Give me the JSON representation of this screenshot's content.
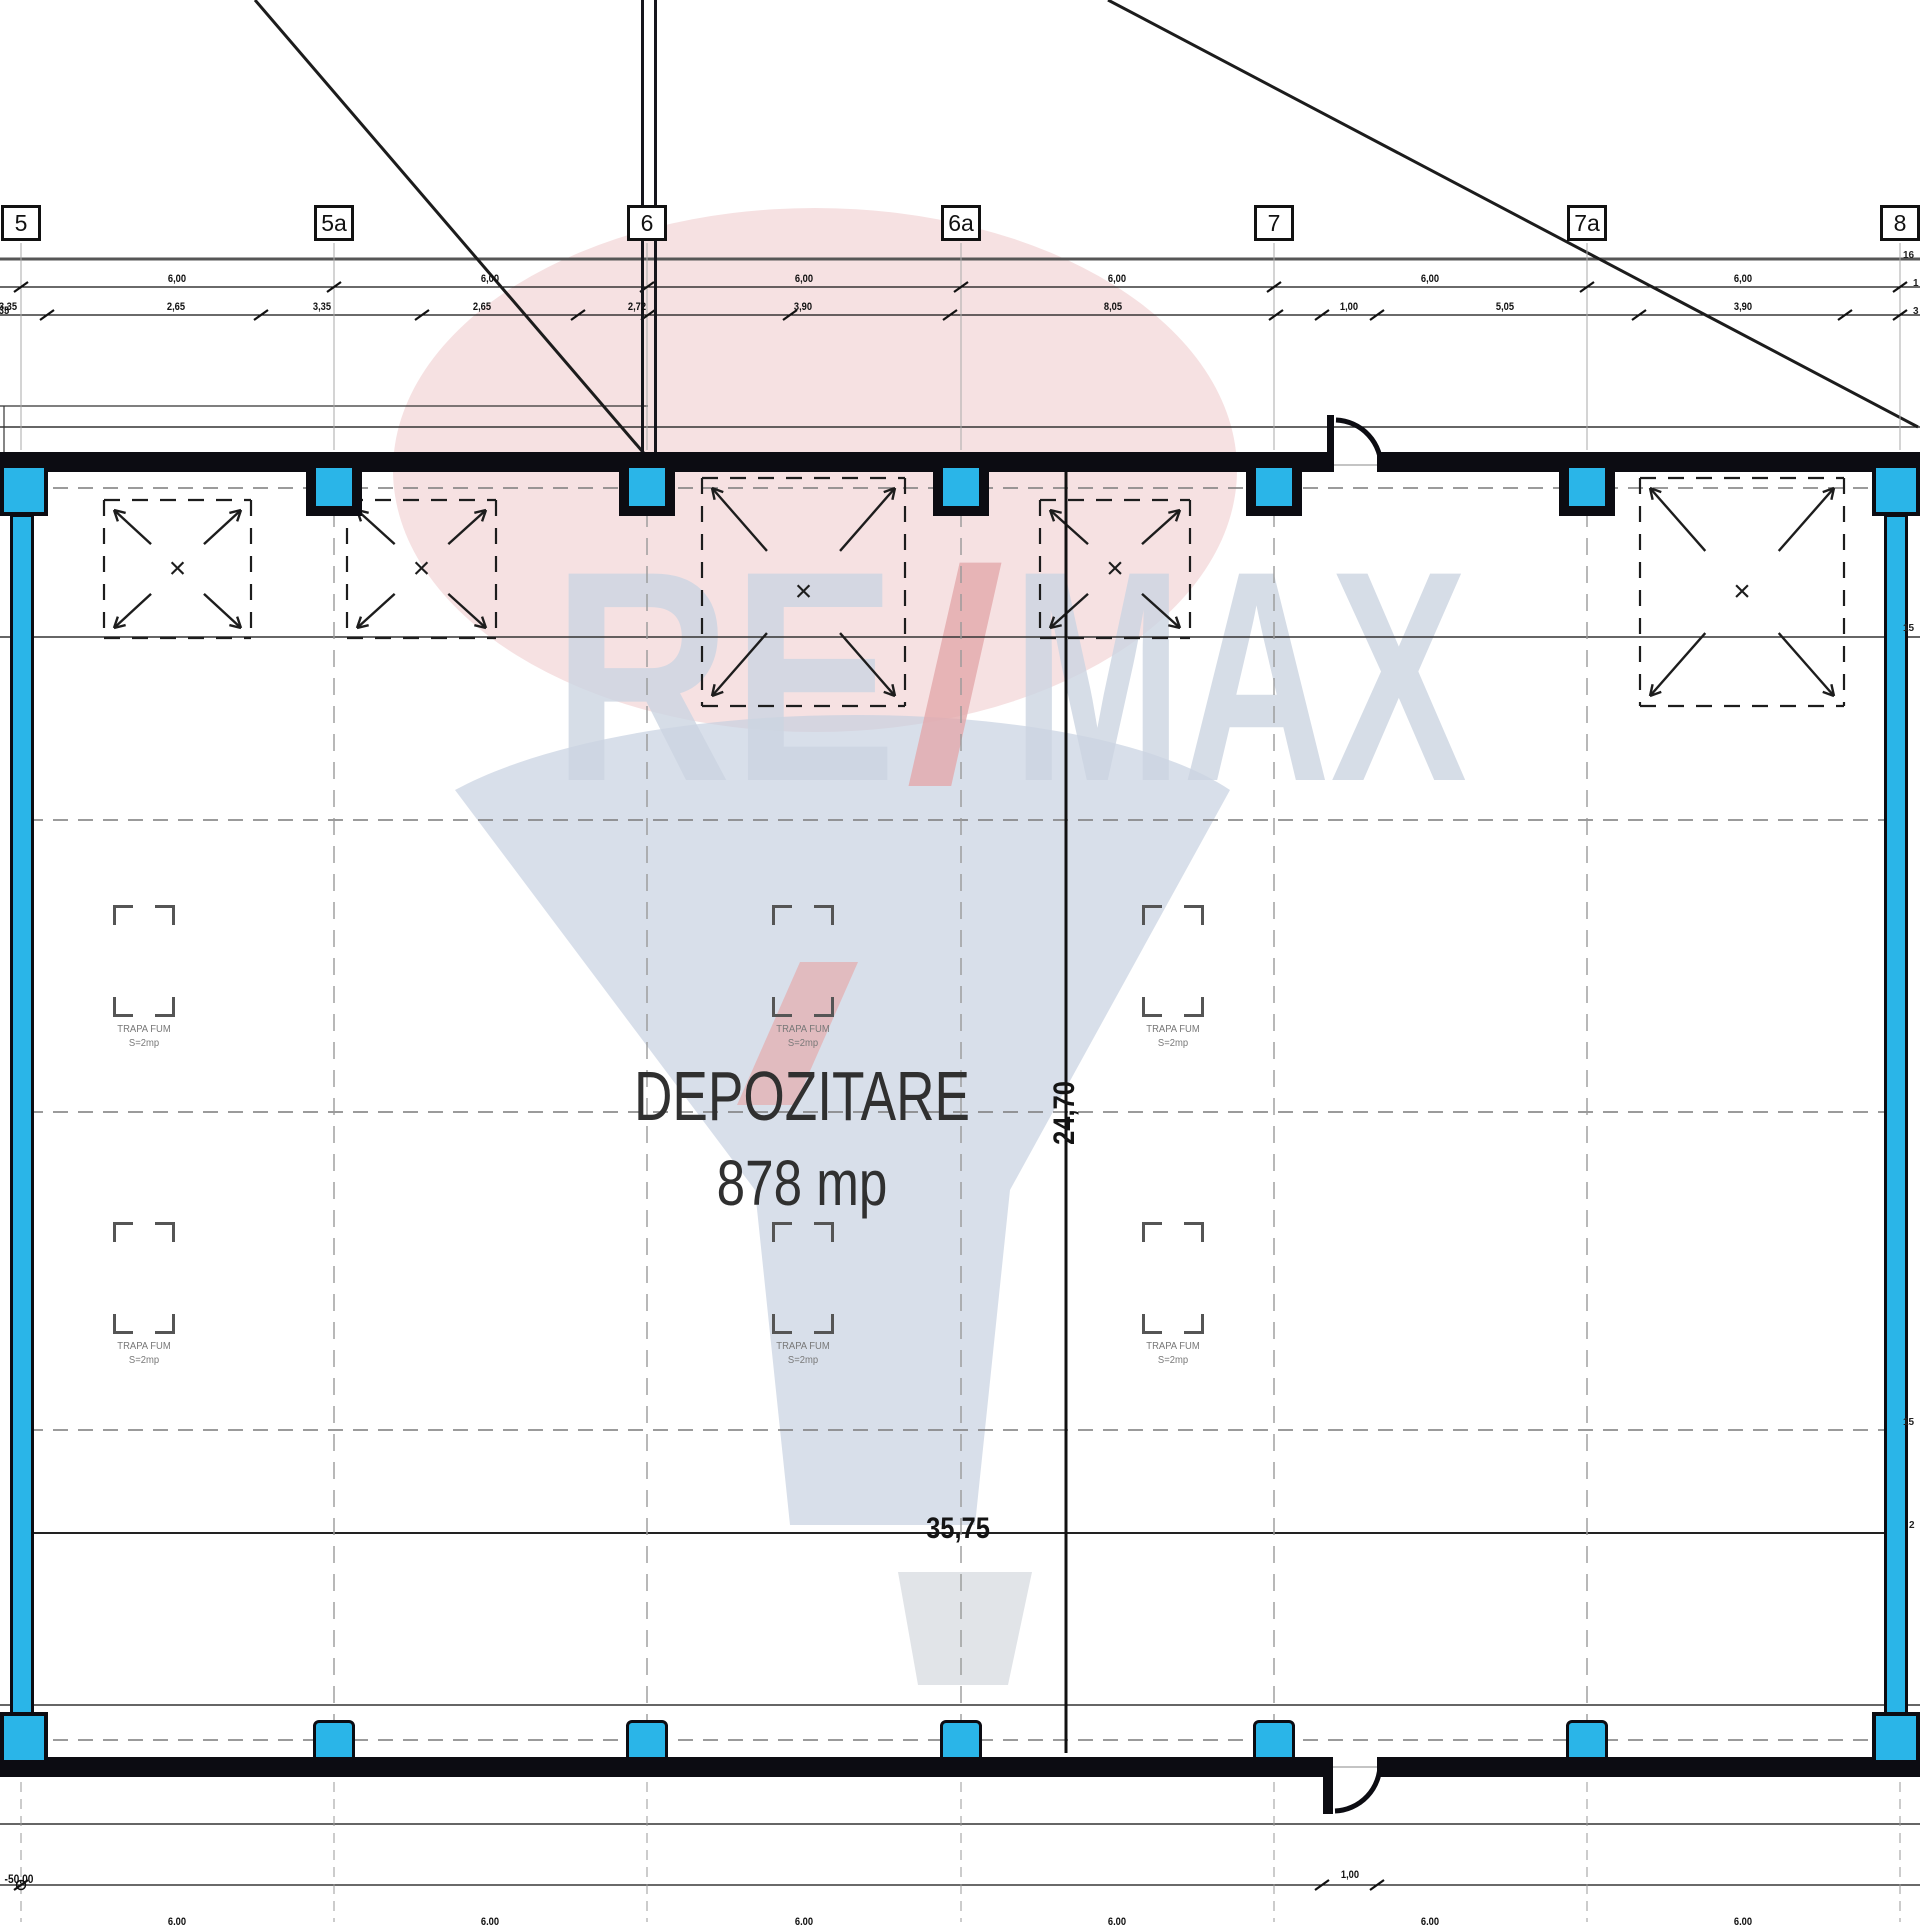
{
  "drawing": {
    "room_label": "DEPOZITARE",
    "room_area": "878 mp",
    "width_dim": "35,75",
    "depth_dim": "24,70",
    "level_dim": "-50,00",
    "door_dim_bottom": "1,00",
    "edge_dim_left": "-3,35"
  },
  "colors": {
    "column_cyan": "#2ab5e8",
    "wall_black": "#0c0c12",
    "balloon_pink": "#eec8ca",
    "balloon_blue": "#c3cedf",
    "balloon_red": "#e6abad",
    "basket_gray": "#dcdfe4"
  },
  "grid_markers": [
    {
      "label": "5",
      "x": 21
    },
    {
      "label": "5a",
      "x": 334
    },
    {
      "label": "6",
      "x": 647
    },
    {
      "label": "6a",
      "x": 961
    },
    {
      "label": "7",
      "x": 1274
    },
    {
      "label": "7a",
      "x": 1587
    },
    {
      "label": "8",
      "x": 1900
    }
  ],
  "dim_row_top": {
    "label": "6,00",
    "positions": [
      177,
      490,
      804,
      1117,
      1430,
      1743
    ],
    "tick_xs": [
      21,
      334,
      647,
      961,
      1274,
      1587,
      1900
    ]
  },
  "dim_row_sub": {
    "labels": [
      {
        "t": "3,35",
        "x": 8
      },
      {
        "t": "2,65",
        "x": 176
      },
      {
        "t": "3,35",
        "x": 322
      },
      {
        "t": "2,65",
        "x": 482
      },
      {
        "t": "2,72",
        "x": 637
      },
      {
        "t": "3,90",
        "x": 803
      },
      {
        "t": "8,05",
        "x": 1113
      },
      {
        "t": "1,00",
        "x": 1349
      },
      {
        "t": "5,05",
        "x": 1505
      },
      {
        "t": "3,90",
        "x": 1743
      }
    ],
    "tick_xs": [
      47,
      261,
      422,
      578,
      648,
      790,
      950,
      1276,
      1322,
      1377,
      1639,
      1845,
      1900
    ]
  },
  "bottom_dim": {
    "clipped_label": "6,00",
    "clipped_positions": [
      177,
      490,
      804,
      1117,
      1430,
      1743
    ],
    "door_tick_xs": [
      1322,
      1377
    ]
  },
  "edge_labels": [
    {
      "t": "16",
      "x": 1903,
      "y": 250
    },
    {
      "t": "1",
      "x": 1913,
      "y": 278
    },
    {
      "t": "3",
      "x": 1913,
      "y": 306
    },
    {
      "t": "15",
      "x": 1903,
      "y": 623
    },
    {
      "t": "15",
      "x": 1903,
      "y": 1417
    },
    {
      "t": "2",
      "x": 1909,
      "y": 1520
    }
  ],
  "trapa": {
    "line1": "TRAPA FUM",
    "line2": "S=2mp",
    "units": [
      {
        "x": 113,
        "y": 905
      },
      {
        "x": 772,
        "y": 905
      },
      {
        "x": 1142,
        "y": 905
      },
      {
        "x": 113,
        "y": 1222
      },
      {
        "x": 772,
        "y": 1222
      },
      {
        "x": 1142,
        "y": 1222
      }
    ]
  },
  "skylight_boxes": [
    {
      "x": 104,
      "y": 500,
      "w": 147,
      "h": 138
    },
    {
      "x": 347,
      "y": 500,
      "w": 149,
      "h": 138
    },
    {
      "x": 702,
      "y": 478,
      "w": 203,
      "h": 228
    },
    {
      "x": 1040,
      "y": 500,
      "w": 150,
      "h": 138
    },
    {
      "x": 1640,
      "y": 478,
      "w": 204,
      "h": 228
    }
  ],
  "columns_top_xs": [
    334,
    647,
    961,
    1274,
    1587
  ],
  "columns_bottom_xs": [
    334,
    647,
    961,
    1274,
    1587
  ],
  "gridline_xs": [
    21,
    334,
    647,
    961,
    1274,
    1587,
    1900
  ],
  "dashed_horizontal_ys": [
    488,
    820,
    1112,
    1430,
    1740
  ],
  "watermark": {
    "re": "RE",
    "slash": "/",
    "max": "MAX"
  }
}
